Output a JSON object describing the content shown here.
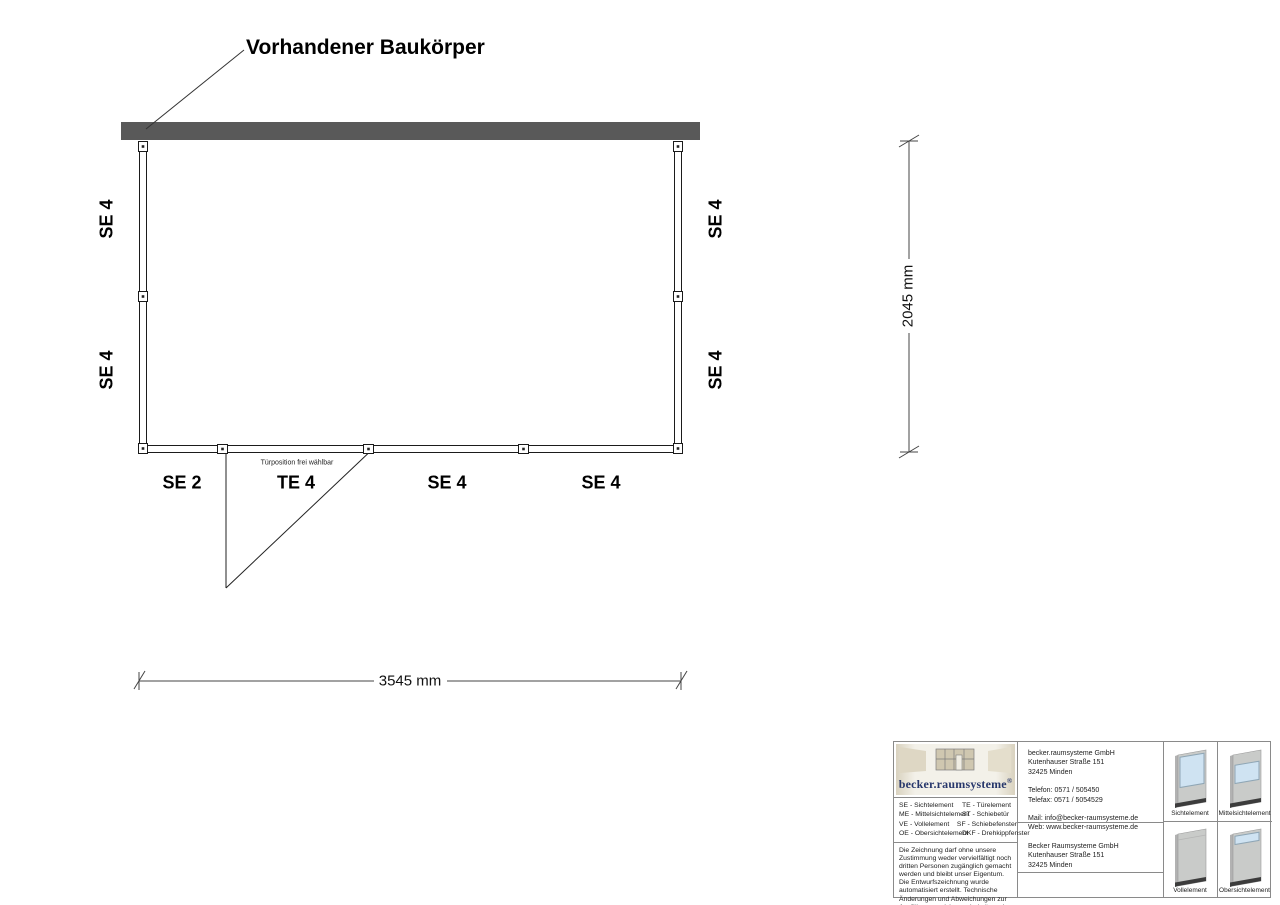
{
  "drawing": {
    "title": "Vorhandener Baukörper",
    "existing_wall_color": "#595959",
    "door_note": "Türposition frei wählbar",
    "labels": {
      "left_top": "SE 4",
      "left_bottom": "SE 4",
      "right_top": "SE 4",
      "right_bottom": "SE 4",
      "bottom_1": "SE 2",
      "bottom_2": "TE 4",
      "bottom_3": "SE 4",
      "bottom_4": "SE 4"
    },
    "dimensions": {
      "width_label": "3545 mm",
      "height_label": "2045 mm"
    }
  },
  "title_block": {
    "logo": {
      "text": "becker.raumsysteme",
      "registered": "®",
      "color": "#27376b"
    },
    "legend": {
      "col1": [
        "SE - Sichtelement",
        "ME - Mittelsichtelement",
        "VE - Vollelement",
        "OE - Obersichtelement"
      ],
      "col2": [
        "TE - Türelement",
        "ST - Schiebetür",
        "SF - Schiebefenster",
        "DKF - Drehkippfenster"
      ]
    },
    "disclaimer": "Die Zeichnung darf ohne unsere Zustimmung weder vervielfältigt noch dritten Personen zugänglich gemacht werden und bleibt unser Eigentum. Die Entwurfszeichnung wurde automatisiert erstellt. Technische Änderungen und Abweichungen zur Ausführungszeichnung behalten wir uns vor.",
    "contact": {
      "company": "becker.raumsysteme GmbH",
      "street": "Kutenhauser Straße 151",
      "city": "32425 Minden",
      "phone": "Telefon: 0571 / 505450",
      "fax": "Telefax: 0571 / 5054529",
      "mail": "Mail: info@becker-raumsysteme.de",
      "web": "Web: www.becker-raumsysteme.de"
    },
    "owner": {
      "company": "Becker Raumsysteme GmbH",
      "street": "Kutenhauser Straße 151",
      "city": "32425 Minden"
    },
    "panels": [
      {
        "label": "Sichtelement",
        "type": "glass-top"
      },
      {
        "label": "Mittelsichtelement",
        "type": "glass-middle"
      },
      {
        "label": "Vollelement",
        "type": "solid"
      },
      {
        "label": "Obersichtelement",
        "type": "glass-strip-top"
      }
    ],
    "colors": {
      "glass": "#cfe3f2",
      "panel": "#c9cbc9",
      "base": "#3c3c3c"
    }
  }
}
